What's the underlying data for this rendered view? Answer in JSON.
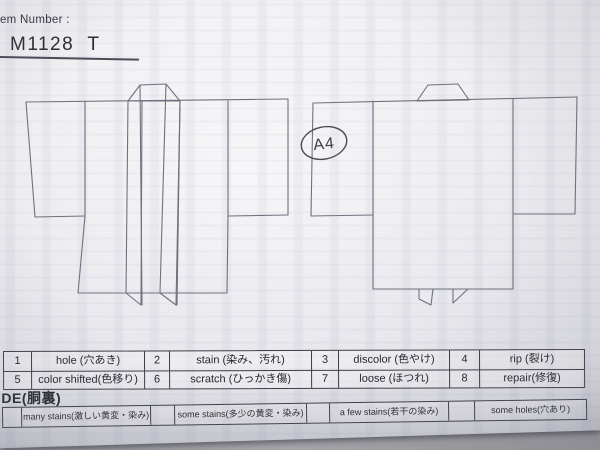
{
  "header": {
    "label": "Item Number :",
    "value": "M1128  T"
  },
  "annotation": {
    "circled_text": "A4"
  },
  "diagrams": {
    "left": "kimono-front-outline",
    "right": "kimono-back-outline"
  },
  "defect_table": {
    "rows": [
      [
        {
          "num": "1",
          "label": "hole (穴あき)"
        },
        {
          "num": "2",
          "label": "stain (染み、汚れ)"
        },
        {
          "num": "3",
          "label": "discolor (色やけ)"
        },
        {
          "num": "4",
          "label": "rip (裂け)"
        }
      ],
      [
        {
          "num": "5",
          "label": "color shifted(色移り)"
        },
        {
          "num": "6",
          "label": "scratch (ひっかき傷)"
        },
        {
          "num": "7",
          "label": "loose (ほつれ)"
        },
        {
          "num": "8",
          "label": "repair(修復)"
        }
      ]
    ]
  },
  "inside_label": "IDE(胴裏)",
  "grade_row": {
    "cells": [
      "many stains(激しい黄変・染み)",
      "some stains(多少の黄変・染み)",
      "a few stains(若干の染み)",
      "some holes(穴あり)"
    ]
  },
  "colors": {
    "paper": "#ebebef",
    "ink": "#26262e",
    "diagram_line": "#70707e",
    "table_border": "#3c3c45",
    "background": "#9b9ba1"
  }
}
